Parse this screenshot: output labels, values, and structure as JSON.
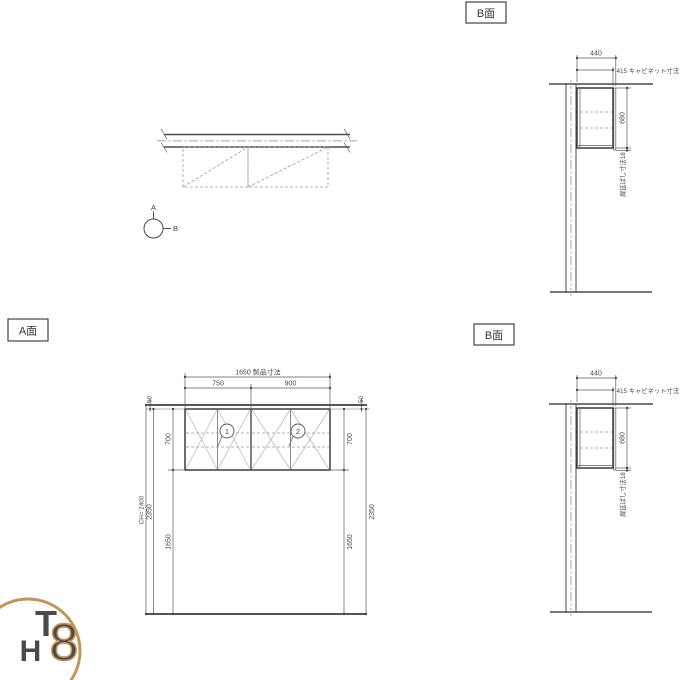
{
  "labels": {
    "view_a": "A面",
    "view_b": "B面"
  },
  "plan": {
    "marker_a": "A",
    "marker_b": "B"
  },
  "elev": {
    "product_width": "1650 製品寸法",
    "left_width": "750",
    "right_width": "900",
    "gap_left": "50",
    "gap_right": "50",
    "height_left": "700",
    "height_right": "700",
    "ceiling_height": "CH= 2400",
    "top_to_floor_left": "2350",
    "top_to_floor_right": "2350",
    "bottom_to_floor_left": "1650",
    "bottom_to_floor_right": "1650",
    "unit1": "1",
    "unit2": "2"
  },
  "side": {
    "depth_total": "440",
    "depth_cabinet": "415 キャビネット寸法",
    "height": "680",
    "door_extension": "扉延ばし寸法18"
  },
  "logo": {
    "letter_t": "T",
    "letter_h": "H",
    "letter_8": "8"
  },
  "colors": {
    "line": "#4a4a4a",
    "light_line": "#9b9b9b",
    "logo_gold": "#c49559"
  }
}
